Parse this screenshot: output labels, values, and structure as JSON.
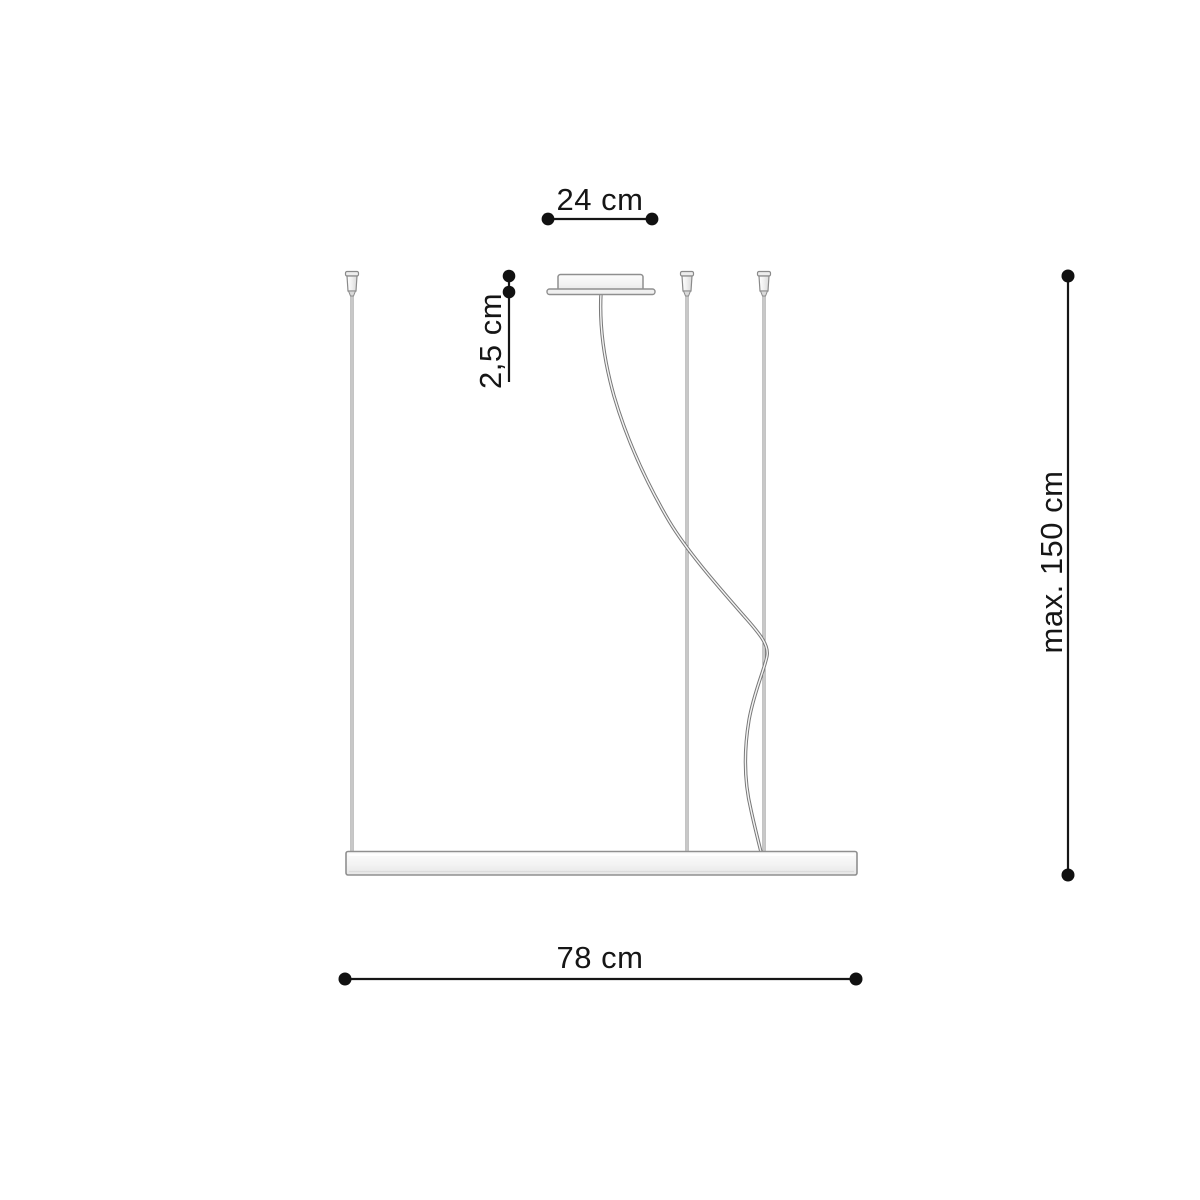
{
  "labels": {
    "canopy_width": "24 cm",
    "canopy_height": "2,5 cm",
    "max_suspension": "max. 150 cm",
    "fixture_length": "78 cm"
  },
  "colors": {
    "dimension_line": "#161616",
    "dimension_dot": "#111111",
    "cable_stroke": "#8a8a8a",
    "cord_stroke": "#787878",
    "fixture_outline": "#8f8f8f",
    "fixture_fill_top": "#fbfbfb",
    "fixture_fill_bottom": "#e8e8e8",
    "background": "#ffffff"
  }
}
